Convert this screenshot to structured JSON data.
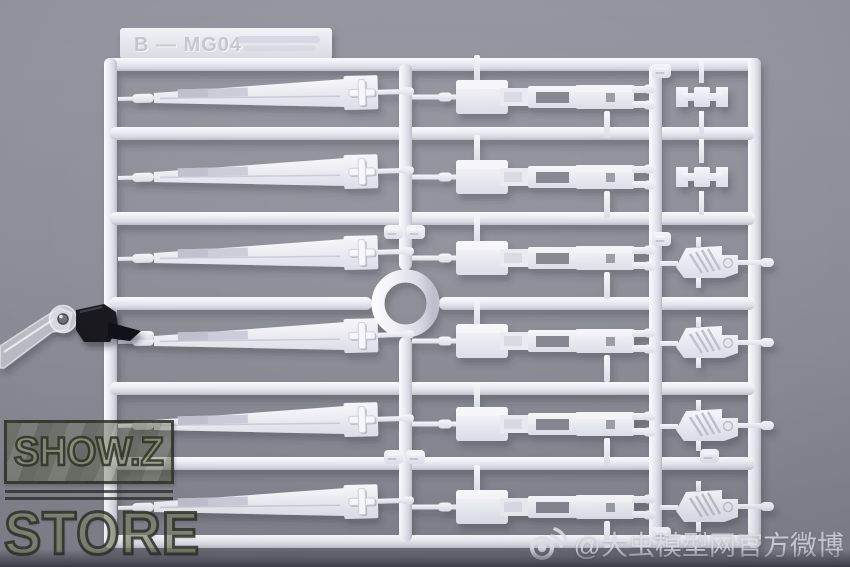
{
  "scene": {
    "type": "product-photo",
    "subject": "White injection-molded model-kit runner (sprue) held by a black clip on a clear display-stand arm, gray studio background",
    "background_top_color": "#95959f",
    "background_bottom_color": "#80808a",
    "plastic_color": "#ededf3",
    "shadow_color": "#32323e"
  },
  "sprue": {
    "tag_text": "B — MG04",
    "rows": 6,
    "left_column_part_count": 6,
    "middle_column_part_count": 6,
    "right_column_bracket_count": 2,
    "right_column_plate_count": 4,
    "has_center_ring": true
  },
  "clamp": {
    "clip_color": "#17171c",
    "arm_style": "transparent acrylic"
  },
  "watermark": {
    "line1": "SHOW.Z",
    "line2": "STORE",
    "camo_fill": "#82876a",
    "outline_color": "#2d3228",
    "weibo_handle": "@大虫模型网官方微博",
    "weibo_color": "#e3e3ea"
  }
}
